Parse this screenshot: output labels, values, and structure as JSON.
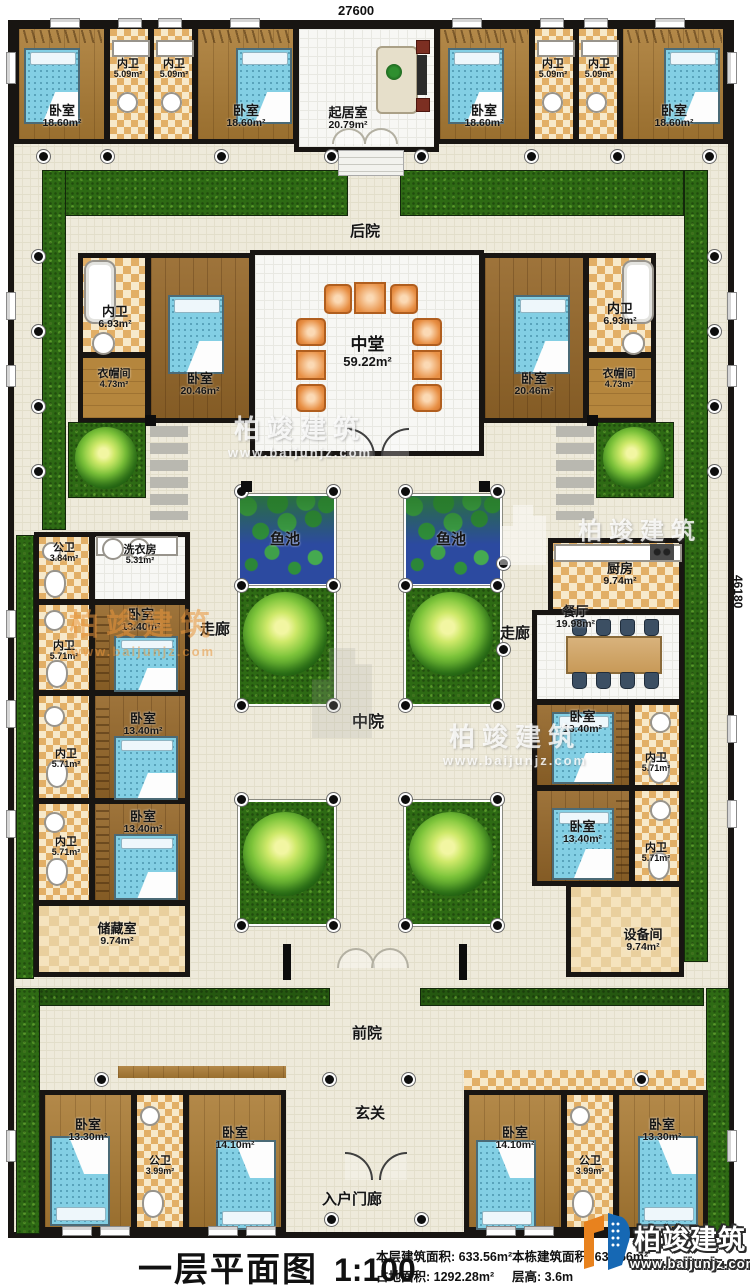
{
  "dims": {
    "width": "27600",
    "height": "46180"
  },
  "zones": {
    "backyard": "后院",
    "middle_yard": "中院",
    "front_yard": "前院",
    "entry_hall": "玄关",
    "entry_porch": "入户门廊",
    "corridor_left": "走廊",
    "corridor_right": "走廊",
    "fish_pond_left": "鱼池",
    "fish_pond_right": "鱼池"
  },
  "rooms": {
    "bedroom_tl1": {
      "name": "卧室",
      "area": "18.60m²"
    },
    "bath_tl1": {
      "name": "内卫",
      "area": "5.09m²"
    },
    "bath_tl2": {
      "name": "内卫",
      "area": "5.09m²"
    },
    "bedroom_tl2": {
      "name": "卧室",
      "area": "18.60m²"
    },
    "living_room": {
      "name": "起居室",
      "area": "20.79m²"
    },
    "bedroom_tr1": {
      "name": "卧室",
      "area": "18.60m²"
    },
    "bath_tr1": {
      "name": "内卫",
      "area": "5.09m²"
    },
    "bath_tr2": {
      "name": "内卫",
      "area": "5.09m²"
    },
    "bedroom_tr2": {
      "name": "卧室",
      "area": "18.60m²"
    },
    "bath_ml": {
      "name": "内卫",
      "area": "6.93m²"
    },
    "cloakroom_l": {
      "name": "衣帽间",
      "area": "4.73m²"
    },
    "bedroom_ml": {
      "name": "卧室",
      "area": "20.46m²"
    },
    "middle_hall": {
      "name": "中堂",
      "area": "59.22m²"
    },
    "bedroom_mr": {
      "name": "卧室",
      "area": "20.46m²"
    },
    "bath_mr": {
      "name": "内卫",
      "area": "6.93m²"
    },
    "cloakroom_r": {
      "name": "衣帽间",
      "area": "4.73m²"
    },
    "public_bath_l": {
      "name": "公卫",
      "area": "3.84m²"
    },
    "laundry": {
      "name": "洗衣房",
      "area": "5.31m²"
    },
    "bedroom_l1": {
      "name": "卧室",
      "area": "13.40m²"
    },
    "bath_l1": {
      "name": "内卫",
      "area": "5.71m²"
    },
    "bedroom_l2": {
      "name": "卧室",
      "area": "13.40m²"
    },
    "bath_l2": {
      "name": "内卫",
      "area": "5.71m²"
    },
    "bedroom_l3": {
      "name": "卧室",
      "area": "13.40m²"
    },
    "bath_l3": {
      "name": "内卫",
      "area": "5.71m²"
    },
    "storage": {
      "name": "储藏室",
      "area": "9.74m²"
    },
    "kitchen": {
      "name": "厨房",
      "area": "9.74m²"
    },
    "dining": {
      "name": "餐厅",
      "area": "19.98m²"
    },
    "bedroom_r1": {
      "name": "卧室",
      "area": "13.40m²"
    },
    "bath_r1": {
      "name": "内卫",
      "area": "5.71m²"
    },
    "bedroom_r2": {
      "name": "卧室",
      "area": "13.40m²"
    },
    "bath_r2": {
      "name": "内卫",
      "area": "5.71m²"
    },
    "equipment": {
      "name": "设备间",
      "area": "9.74m²"
    },
    "bedroom_bl1": {
      "name": "卧室",
      "area": "13.30m²"
    },
    "public_bath_bl": {
      "name": "公卫",
      "area": "3.99m²"
    },
    "bedroom_bl2": {
      "name": "卧室",
      "area": "14.10m²"
    },
    "bedroom_br1": {
      "name": "卧室",
      "area": "14.10m²"
    },
    "public_bath_br": {
      "name": "公卫",
      "area": "3.99m²"
    },
    "bedroom_br2": {
      "name": "卧室",
      "area": "13.30m²"
    }
  },
  "titlebar": {
    "title": "一层平面图",
    "scale": "1:100",
    "stats": [
      {
        "label": "本层建筑面积:",
        "value": "633.56m²"
      },
      {
        "label": "占地面积:",
        "value": "1292.28m²"
      },
      {
        "label": "本栋建筑面积:",
        "value": "633.56m²"
      },
      {
        "label": "层高:",
        "value": "3.6m"
      }
    ]
  },
  "brand": {
    "name": "柏竣建筑",
    "url": "www.baijunjz.com"
  }
}
